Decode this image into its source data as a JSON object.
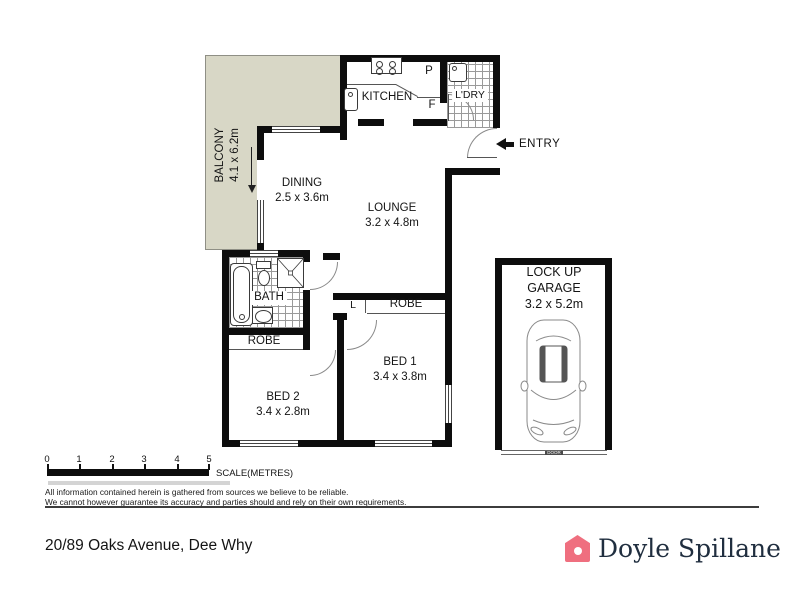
{
  "floorplan": {
    "balcony": {
      "name": "BALCONY",
      "dims": "4.1 x 6.2m"
    },
    "kitchen": {
      "name": "KITCHEN",
      "pantry": "P",
      "fridge": "F"
    },
    "laundry": {
      "name": "L'DRY"
    },
    "entry": {
      "name": "ENTRY"
    },
    "dining": {
      "name": "DINING",
      "dims": "2.5 x 3.6m"
    },
    "lounge": {
      "name": "LOUNGE",
      "dims": "3.2 x 4.8m"
    },
    "bath": {
      "name": "BATH"
    },
    "robe_bed2": "ROBE",
    "linen": "L",
    "robe_bed1": "ROBE",
    "bed2": {
      "name": "BED 2",
      "dims": "3.4 x 2.8m"
    },
    "bed1": {
      "name": "BED 1",
      "dims": "3.4 x 3.8m"
    },
    "garage": {
      "name_line1": "LOCK UP",
      "name_line2": "GARAGE",
      "dims": "3.2 x 5.2m",
      "door": "DOOR"
    }
  },
  "scale": {
    "ticks": [
      "0",
      "1",
      "2",
      "3",
      "4",
      "5"
    ],
    "label": "SCALE(METRES)"
  },
  "disclaimer": {
    "line1": "All information contained herein is gathered from sources we believe to be reliable.",
    "line2": "We cannot however guarantee its accuracy and parties should and rely on their own requirements."
  },
  "footer": {
    "address": "20/89 Oaks Avenue, Dee Why",
    "agency": "Doyle Spillane"
  },
  "colors": {
    "balcony_fill": "#d8d7c6",
    "wall": "#0d0d0d",
    "logo_pink": "#ef6f7f",
    "logo_navy": "#202e3f"
  }
}
